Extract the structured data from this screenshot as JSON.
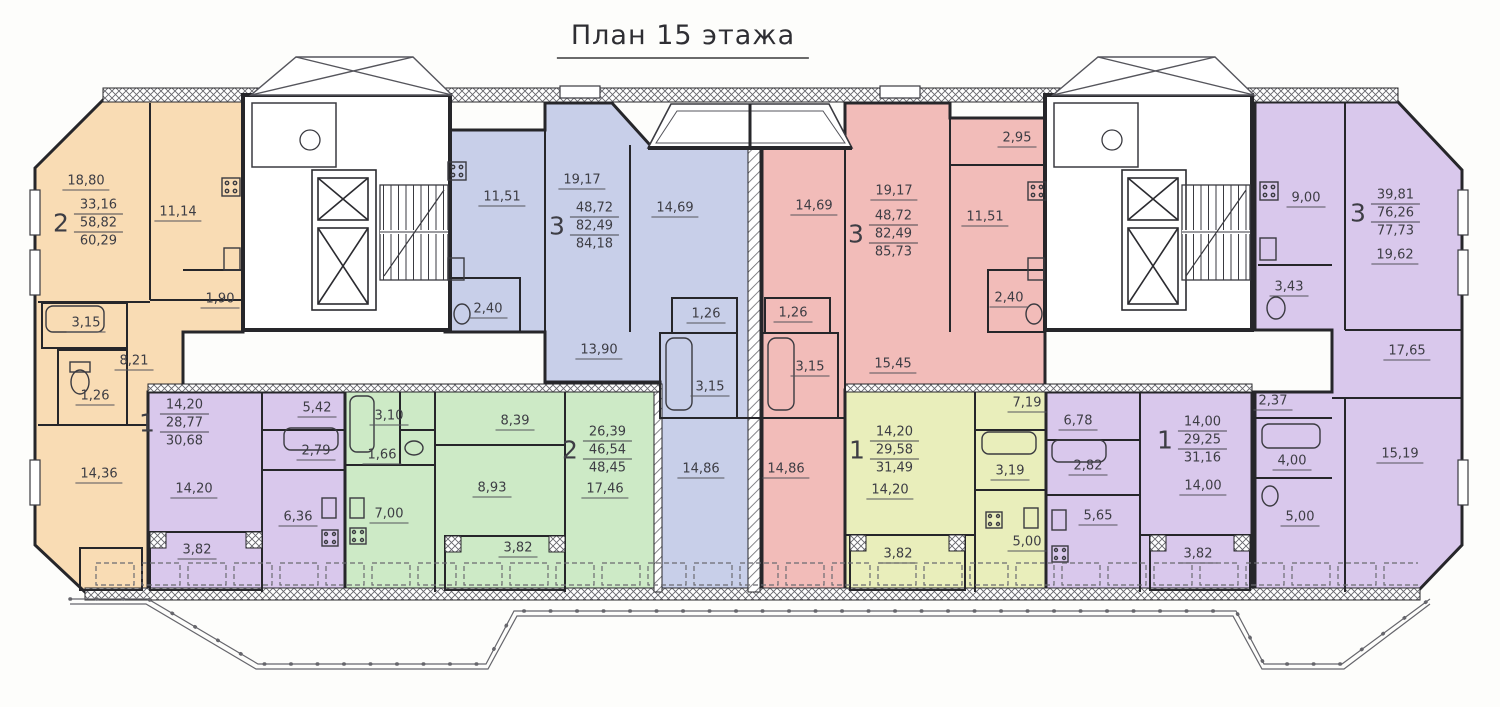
{
  "title": "План 15 этажа",
  "colors": {
    "orange": "#f9dcb4",
    "blue": "#c8cfe9",
    "red": "#f2bcb9",
    "purple": "#d9c8ec",
    "green": "#cdeac6",
    "yellow": "#e9eebb",
    "wall": "#26262a",
    "label": "#3d3d44"
  },
  "apartments": [
    {
      "name": "2-room orange (left)",
      "type": "2",
      "living": "33,16",
      "area": "58,82",
      "total": "60,29",
      "rooms": {
        "room1": "18,80",
        "kitchen": "11,14",
        "lobby": "1,90",
        "bath": "3,15",
        "hall": "8,21",
        "wc": "1,26",
        "room2": "14,36"
      }
    },
    {
      "name": "1-room purple (left)",
      "type": "1",
      "living": "14,20",
      "area": "28,77",
      "total": "30,68",
      "rooms": {
        "room": "14,20",
        "hall": "5,42",
        "bath": "2,79",
        "kitchen": "6,36",
        "balcony": "3,82"
      }
    },
    {
      "name": "2-room green",
      "type": "2",
      "living": "26,39",
      "area": "46,54",
      "total": "48,45",
      "rooms": {
        "bath": "3,10",
        "wc": "1,66",
        "kitchen": "7,00",
        "hall": "8,39",
        "room1": "8,93",
        "balcony": "3,82",
        "room2": "17,46"
      }
    },
    {
      "name": "3-room blue",
      "type": "3",
      "living": "48,72",
      "area": "82,49",
      "total": "84,18",
      "rooms": {
        "kitchen": "11,51",
        "room1": "19,17",
        "room2": "14,69",
        "wc": "2,40",
        "hall": "13,90",
        "wc2": "1,26",
        "bath": "3,15",
        "room3": "14,86"
      }
    },
    {
      "name": "3-room red",
      "type": "3",
      "living": "48,72",
      "area": "82,49",
      "total": "85,73",
      "rooms": {
        "room1": "14,69",
        "room2": "19,17",
        "loggia": "2,95",
        "kitchen": "11,51",
        "wc": "2,40",
        "wc2": "1,26",
        "bath": "3,15",
        "hall": "15,45",
        "room3": "14,86"
      }
    },
    {
      "name": "1-room yellow",
      "type": "1",
      "living": "14,20",
      "area": "29,58",
      "total": "31,49",
      "rooms": {
        "hall": "7,19",
        "room": "14,20",
        "bath": "3,19",
        "kitchen": "5,00",
        "balcony": "3,82"
      }
    },
    {
      "name": "1-room purple (right)",
      "type": "1",
      "living": "14,00",
      "area": "29,25",
      "total": "31,16",
      "rooms": {
        "hall": "6,78",
        "bath": "2,82",
        "kitchen": "5,65",
        "room": "14,00",
        "balcony": "3,82"
      }
    },
    {
      "name": "3-room purple (right)",
      "type": "3",
      "living": "39,81",
      "area": "76,26",
      "total": "77,73",
      "rooms": {
        "kitchen": "9,00",
        "room1": "19,62",
        "wc": "3,43",
        "hall": "17,65",
        "storage": "2,37",
        "bath": "4,00",
        "room2": "5,00",
        "room3": "15,19"
      }
    }
  ]
}
